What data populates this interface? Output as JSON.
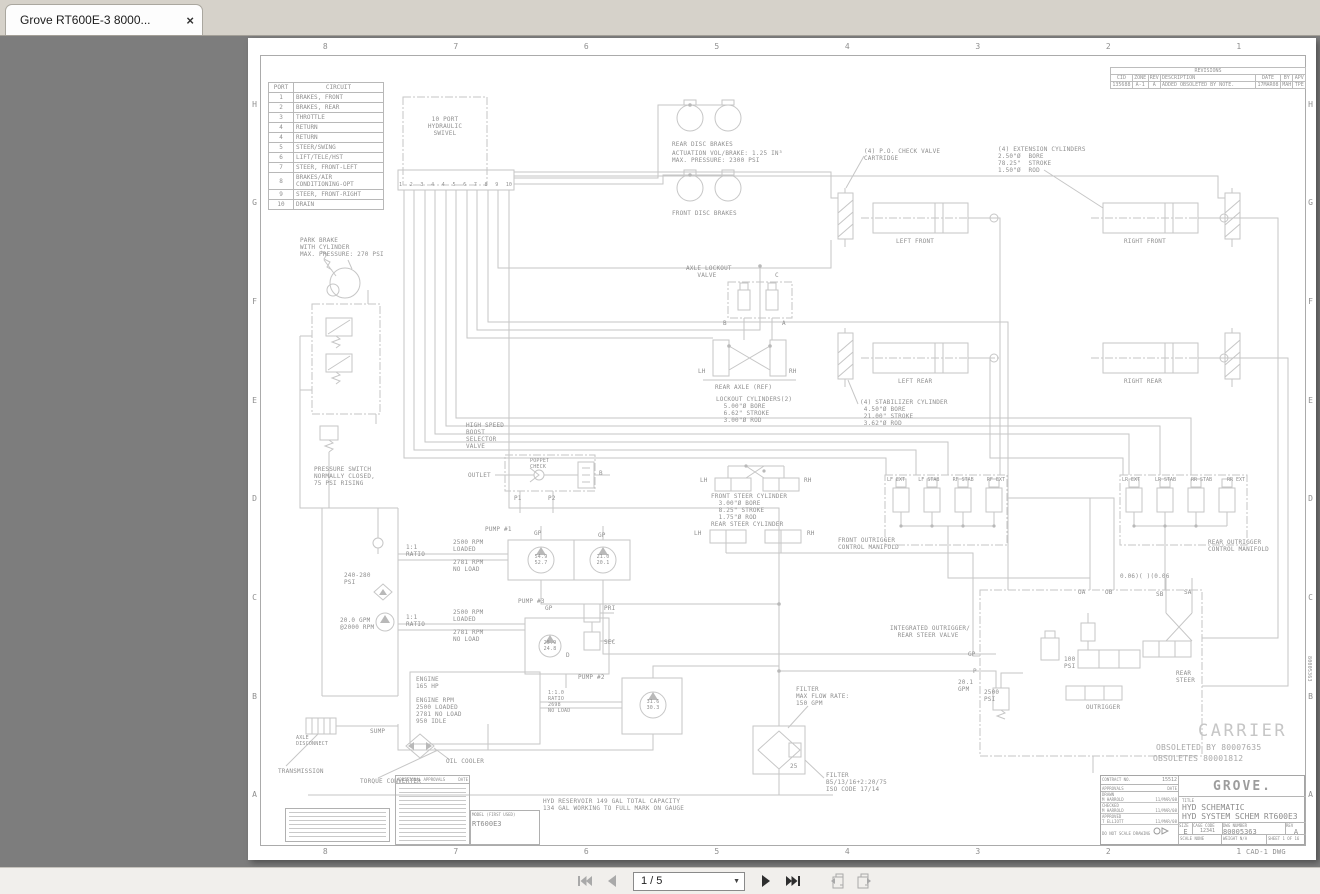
{
  "window": {
    "tab_title": "Grove RT600E-3 8000...",
    "close_glyph": "×"
  },
  "statusbar": {
    "page_display": "1 / 5",
    "icons": [
      "first-page",
      "previous-page",
      "next-page",
      "last-page",
      "previous-view",
      "next-view"
    ],
    "caret_glyph": "▼"
  },
  "drawing": {
    "zones": {
      "cols": [
        "8",
        "7",
        "6",
        "5",
        "4",
        "3",
        "2",
        "1"
      ],
      "rows": [
        "H",
        "G",
        "F",
        "E",
        "D",
        "C",
        "B",
        "A"
      ]
    },
    "revisions": {
      "title": "REVISIONS",
      "headers": [
        "CID",
        "ZONE",
        "REV",
        "DESCRIPTION",
        "DATE",
        "BY",
        "APV"
      ],
      "row": [
        "135688",
        "A-1",
        "A",
        "ADDED OBSOLETED BY NOTE.",
        "17MAR08",
        "MAH",
        "TPE"
      ]
    },
    "port_table": {
      "headers": [
        "PORT",
        "CIRCUIT"
      ],
      "rows": [
        [
          "1",
          "BRAKES, FRONT"
        ],
        [
          "2",
          "BRAKES, REAR"
        ],
        [
          "3",
          "THROTTLE"
        ],
        [
          "4",
          "RETURN"
        ],
        [
          "4",
          "RETURN"
        ],
        [
          "5",
          "STEER/SWING"
        ],
        [
          "6",
          "LIFT/TELE/HST"
        ],
        [
          "7",
          "STEER, FRONT-LEFT"
        ],
        [
          "8",
          "BRAKES/AIR CONDITIONING-OPT"
        ],
        [
          "9",
          "STEER, FRONT-RIGHT"
        ],
        [
          "10",
          "DRAIN"
        ]
      ]
    },
    "swivel_ports": [
      "1",
      "2",
      "3",
      "4",
      "4",
      "5",
      "6",
      "7",
      "8",
      "9",
      "10"
    ],
    "front_manifold_valves": [
      "LF EXT",
      "LF STAB",
      "RF STAB",
      "RF EXT"
    ],
    "rear_manifold_valves": [
      "LR EXT",
      "LR STAB",
      "RR STAB",
      "RR EXT"
    ],
    "labels": [
      {
        "n": "swivel-label",
        "t": "10 PORT\nHYDRAULIC\nSWIVEL",
        "x": 197,
        "y": 78,
        "c": 1
      },
      {
        "n": "park-brake-note",
        "t": "PARK BRAKE\nWITH CYLINDER\nMAX. PRESSURE: 270 PSI",
        "x": 52,
        "y": 199
      },
      {
        "n": "pressure-switch-note",
        "t": "PRESSURE SWITCH\nNORMALLY CLOSED,\n75 PSI RISING",
        "x": 66,
        "y": 428
      },
      {
        "n": "psi-240-280-label",
        "t": "240-280\nPSI",
        "x": 96,
        "y": 534
      },
      {
        "n": "gpm-20-label",
        "t": "20.0 GPM\n@2000 RPM",
        "x": 92,
        "y": 579
      },
      {
        "n": "boost-valve-label",
        "t": "HIGH SPEED\nBOOST\nSELECTOR\nVALVE",
        "x": 218,
        "y": 384
      },
      {
        "n": "outlet-label",
        "t": "OUTLET",
        "x": 220,
        "y": 434
      },
      {
        "n": "poppet-check-label",
        "t": "POPPET\nCHECK",
        "x": 282,
        "y": 420,
        "s": 5
      },
      {
        "n": "port-p1-label",
        "t": "P1",
        "x": 266,
        "y": 457
      },
      {
        "n": "port-p2-label",
        "t": "P2",
        "x": 300,
        "y": 457
      },
      {
        "n": "port-b-boost-label",
        "t": "B",
        "x": 351,
        "y": 432
      },
      {
        "n": "pump1-label",
        "t": "PUMP #1",
        "x": 237,
        "y": 488
      },
      {
        "n": "gp-label-1",
        "t": "GP",
        "x": 286,
        "y": 492
      },
      {
        "n": "gp-label-2",
        "t": "GP",
        "x": 350,
        "y": 494
      },
      {
        "n": "ratio-label-1",
        "t": "1:1\nRATIO",
        "x": 158,
        "y": 506
      },
      {
        "n": "rpm-loaded-1",
        "t": "2500 RPM\nLOADED",
        "x": 205,
        "y": 501
      },
      {
        "n": "rpm-noload-1",
        "t": "2781 RPM\nNO LOAD",
        "x": 205,
        "y": 521
      },
      {
        "n": "pump1-gauge-a",
        "t": "54.9\n52.7",
        "x": 293,
        "y": 516,
        "s": 5,
        "c": 1
      },
      {
        "n": "pump1-gauge-b",
        "t": "21.0\n20.1",
        "x": 355,
        "y": 516,
        "s": 5,
        "c": 1
      },
      {
        "n": "pump3-label",
        "t": "PUMP #3",
        "x": 270,
        "y": 560
      },
      {
        "n": "gp-label-3",
        "t": "GP",
        "x": 297,
        "y": 567
      },
      {
        "n": "ratio-label-2",
        "t": "1:1\nRATIO",
        "x": 158,
        "y": 576
      },
      {
        "n": "rpm-loaded-2",
        "t": "2500 RPM\nLOADED",
        "x": 205,
        "y": 571
      },
      {
        "n": "rpm-noload-2",
        "t": "2781 RPM\nNO LOAD",
        "x": 205,
        "y": 591
      },
      {
        "n": "pump3-gauge",
        "t": "25.9\n24.8",
        "x": 302,
        "y": 602,
        "s": 5,
        "c": 1
      },
      {
        "n": "pri-label",
        "t": "PRI",
        "x": 356,
        "y": 567
      },
      {
        "n": "sec-label",
        "t": "SEC",
        "x": 356,
        "y": 601
      },
      {
        "n": "port-d-label",
        "t": "D",
        "x": 318,
        "y": 614
      },
      {
        "n": "engine-note",
        "t": "ENGINE\n165 HP\n\nENGINE RPM\n2500 LOADED\n2781 NO LOAD\n950 IDLE",
        "x": 168,
        "y": 638
      },
      {
        "n": "pump2-label",
        "t": "PUMP #2",
        "x": 330,
        "y": 636
      },
      {
        "n": "ratio-label-3",
        "t": "1:1.0\nRATIO\n2698\nNO LOAD",
        "x": 300,
        "y": 652,
        "s": 5
      },
      {
        "n": "pump2-gauge",
        "t": "31.6\n30.3",
        "x": 405,
        "y": 661,
        "s": 5,
        "c": 1
      },
      {
        "n": "sump-label",
        "t": "SUMP",
        "x": 122,
        "y": 690
      },
      {
        "n": "axle-disconnect-label",
        "t": "AXLE\nDISCONNECT",
        "x": 48,
        "y": 697,
        "s": 5
      },
      {
        "n": "transmission-label",
        "t": "TRANSMISSION",
        "x": 30,
        "y": 730
      },
      {
        "n": "torque-converter-label",
        "t": "TORQUE CONVERTER",
        "x": 112,
        "y": 740
      },
      {
        "n": "oil-cooler-label",
        "t": "OIL COOLER",
        "x": 198,
        "y": 720
      },
      {
        "n": "rear-disc-brakes-label",
        "t": "REAR DISC BRAKES",
        "x": 424,
        "y": 103
      },
      {
        "n": "actuation-note",
        "t": "ACTUATION VOL/BRAKE: 1.25 IN³\nMAX. PRESSURE: 2300 PSI",
        "x": 424,
        "y": 112
      },
      {
        "n": "front-disc-brakes-label",
        "t": "FRONT DISC BRAKES",
        "x": 424,
        "y": 172
      },
      {
        "n": "check-valve-note",
        "t": "(4) P.O. CHECK VALVE\nCARTRIDGE",
        "x": 616,
        "y": 110
      },
      {
        "n": "extension-cylinders-note",
        "t": "(4) EXTENSION CYLINDERS\n2.50\"Ø  BORE\n78.25\"  STROKE\n1.50\"Ø  ROD",
        "x": 750,
        "y": 108
      },
      {
        "n": "left-front-label",
        "t": "LEFT FRONT",
        "x": 648,
        "y": 200
      },
      {
        "n": "right-front-label",
        "t": "RIGHT FRONT",
        "x": 876,
        "y": 200
      },
      {
        "n": "left-rear-label",
        "t": "LEFT REAR",
        "x": 650,
        "y": 340
      },
      {
        "n": "right-rear-label",
        "t": "RIGHT REAR",
        "x": 876,
        "y": 340
      },
      {
        "n": "stabilizer-cylinder-note",
        "t": "(4) STABILIZER CYLINDER\n 4.50\"Ø BORE\n 21.00\" STROKE\n 3.62\"Ø ROD",
        "x": 612,
        "y": 361
      },
      {
        "n": "axle-lockout-label",
        "t": "AXLE LOCKOUT\n   VALVE",
        "x": 438,
        "y": 227
      },
      {
        "n": "port-c-label",
        "t": "C",
        "x": 527,
        "y": 234
      },
      {
        "n": "port-b-lockout-label",
        "t": "B",
        "x": 475,
        "y": 282
      },
      {
        "n": "port-a-lockout-label",
        "t": "A",
        "x": 534,
        "y": 282
      },
      {
        "n": "lh-axle-label",
        "t": "LH",
        "x": 450,
        "y": 330
      },
      {
        "n": "rh-axle-label",
        "t": "RH",
        "x": 541,
        "y": 330
      },
      {
        "n": "rear-axle-label",
        "t": "REAR AXLE (REF)",
        "x": 467,
        "y": 346
      },
      {
        "n": "lockout-cylinders-note",
        "t": "LOCKOUT CYLINDERS(2)\n  5.00\"Ø BORE\n  6.62\" STROKE\n  3.00\"Ø ROD",
        "x": 468,
        "y": 358
      },
      {
        "n": "lh-front-steer-label",
        "t": "LH",
        "x": 452,
        "y": 439
      },
      {
        "n": "rh-front-steer-label",
        "t": "RH",
        "x": 556,
        "y": 439
      },
      {
        "n": "front-steer-note",
        "t": "FRONT STEER CYLINDER\n  3.00\"Ø BORE\n  8.25\" STROKE\n  1.75\"Ø ROD",
        "x": 463,
        "y": 455
      },
      {
        "n": "rear-steer-cyl-label",
        "t": "REAR STEER CYLINDER",
        "x": 463,
        "y": 483
      },
      {
        "n": "lh-rear-steer-label",
        "t": "LH",
        "x": 446,
        "y": 492
      },
      {
        "n": "rh-rear-steer-label",
        "t": "RH",
        "x": 559,
        "y": 492
      },
      {
        "n": "front-manifold-label",
        "t": "FRONT OUTRIGGER\nCONTROL MANIFOLD",
        "x": 590,
        "y": 499
      },
      {
        "n": "rear-manifold-label",
        "t": "REAR OUTRIGGER\nCONTROL MANIFOLD",
        "x": 960,
        "y": 501
      },
      {
        "n": "filter-note",
        "t": "FILTER\nMAX FLOW RATE:\n150 GPM",
        "x": 548,
        "y": 648
      },
      {
        "n": "filter-bypass-label",
        "t": "25",
        "x": 542,
        "y": 725
      },
      {
        "n": "filter-spec-note",
        "t": "FILTER\nB5/13/16+2:20/75\nISO CODE 17/14",
        "x": 578,
        "y": 734
      },
      {
        "n": "reservoir-note",
        "t": "HYD RESERVOIR 149 GAL TOTAL CAPACITY\n134 GAL WORKING TO FULL MARK ON GAUGE",
        "x": 295,
        "y": 760
      },
      {
        "n": "integrated-valve-label",
        "t": "INTEGRATED OUTRIGGER/\n  REAR STEER VALVE",
        "x": 642,
        "y": 587
      },
      {
        "n": "orifice-note",
        "t": "0.06)( )(0.06",
        "x": 872,
        "y": 535
      },
      {
        "n": "port-oa-label",
        "t": "OA",
        "x": 830,
        "y": 551
      },
      {
        "n": "port-ob-label",
        "t": "OB",
        "x": 857,
        "y": 551
      },
      {
        "n": "port-sb-label",
        "t": "SB",
        "x": 908,
        "y": 553
      },
      {
        "n": "port-sa-label",
        "t": "SA",
        "x": 936,
        "y": 551
      },
      {
        "n": "gp-label-4",
        "t": "GP",
        "x": 720,
        "y": 613
      },
      {
        "n": "port-p-label",
        "t": "P",
        "x": 725,
        "y": 630
      },
      {
        "n": "gpm-201-label",
        "t": "20.1\nGPM",
        "x": 710,
        "y": 641
      },
      {
        "n": "psi-2500-label",
        "t": "2500\nPSI",
        "x": 736,
        "y": 651
      },
      {
        "n": "psi-100-label",
        "t": "100\nPSI",
        "x": 816,
        "y": 618
      },
      {
        "n": "outrigger-label",
        "t": "OUTRIGGER",
        "x": 838,
        "y": 666
      },
      {
        "n": "rear-steer-valve-label",
        "t": "REAR\nSTEER",
        "x": 928,
        "y": 632
      },
      {
        "n": "carrier-text",
        "t": "CARRIER",
        "x": 950,
        "y": 684,
        "big": 1
      },
      {
        "n": "obsoleted-by-note",
        "t": "OBSOLETED BY 80007635",
        "x": 908,
        "y": 705,
        "s": 8,
        "col": "#a9a9a9"
      },
      {
        "n": "obsoletes-note",
        "t": "OBSOLETES 80001812",
        "x": 905,
        "y": 716,
        "s": 8,
        "col": "#a9a9a9"
      },
      {
        "n": "cad-dwg-label",
        "t": "CAD-1 DWG",
        "x": 998,
        "y": 810,
        "s": 7
      },
      {
        "n": "dwg-number-vertical",
        "t": "80005363",
        "x": 1064,
        "y": 618,
        "s": 5,
        "rot": 1
      }
    ],
    "title_block": {
      "ecn": "15512",
      "contract_label": "CONTRACT NO.",
      "approvals_label": "APPROVALS",
      "date_label": "DATE",
      "rows": [
        [
          "DRAWN",
          "M HARROLD",
          "11/MAR/08"
        ],
        [
          "CHECKED",
          "M HARROLD",
          "11/MAR/08"
        ],
        [
          "APPROVED",
          "T ELLIOTT",
          "11/MAR/08"
        ]
      ],
      "do_not_scale": "DO NOT SCALE DRAWING",
      "logo": "GROVE.",
      "title_label": "TITLE",
      "title_line1": "HYD SCHEMATIC",
      "title_line2": "HYD SYSTEM SCHEM RT600E3",
      "size_label": "SIZE",
      "size": "E",
      "cage_label": "CAGE CODE",
      "cage": "12341",
      "dwg_label": "DWG NUMBER",
      "dwg": "80005363",
      "rev_label": "REV",
      "rev": "A",
      "scale_label": "SCALE",
      "scale": "NONE",
      "weight_label": "WEIGHT",
      "weight": "N/A",
      "sheet_label": "SHEET",
      "sheet": "1 OF 16",
      "model_label": "MODEL (FIRST USED)",
      "model": "RT600E3",
      "addl_label": "ADDITIONAL APPROVALS"
    }
  }
}
